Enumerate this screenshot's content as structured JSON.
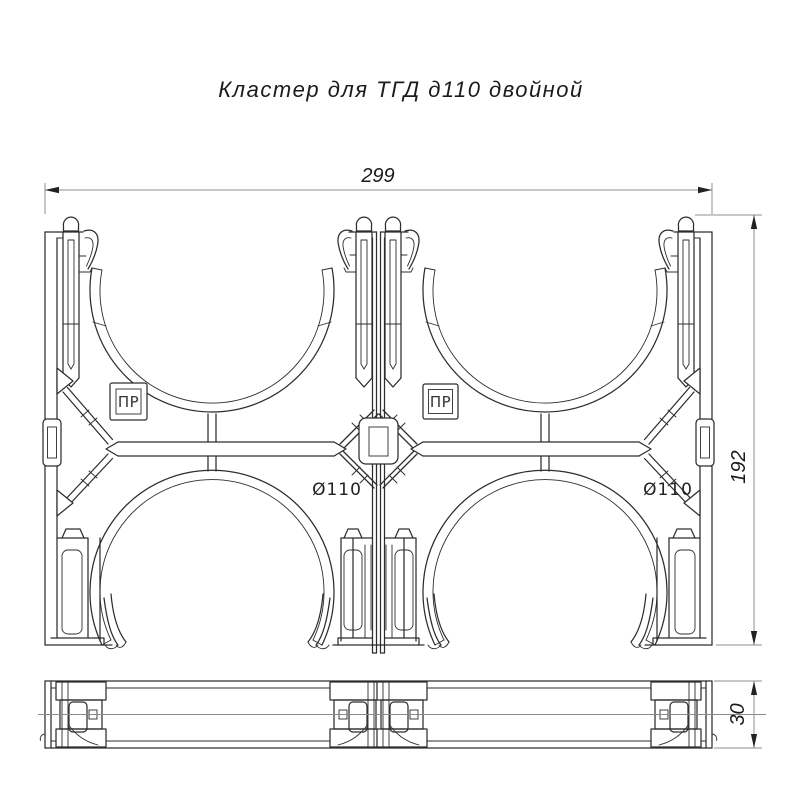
{
  "title": "Кластер для ТГД д110 двойной",
  "dimensions": {
    "overall_width": "299",
    "overall_height": "192",
    "thickness": "30"
  },
  "labels": {
    "pipe_diameter_left": "Ø110",
    "pipe_diameter_right": "Ø110",
    "mold_mark_left": "ПР",
    "mold_mark_right": "ПР"
  },
  "colors": {
    "line": "#2d2d2d",
    "dimension_line": "#8f8f8f",
    "text": "#1b1b1b",
    "background": "#ffffff"
  }
}
